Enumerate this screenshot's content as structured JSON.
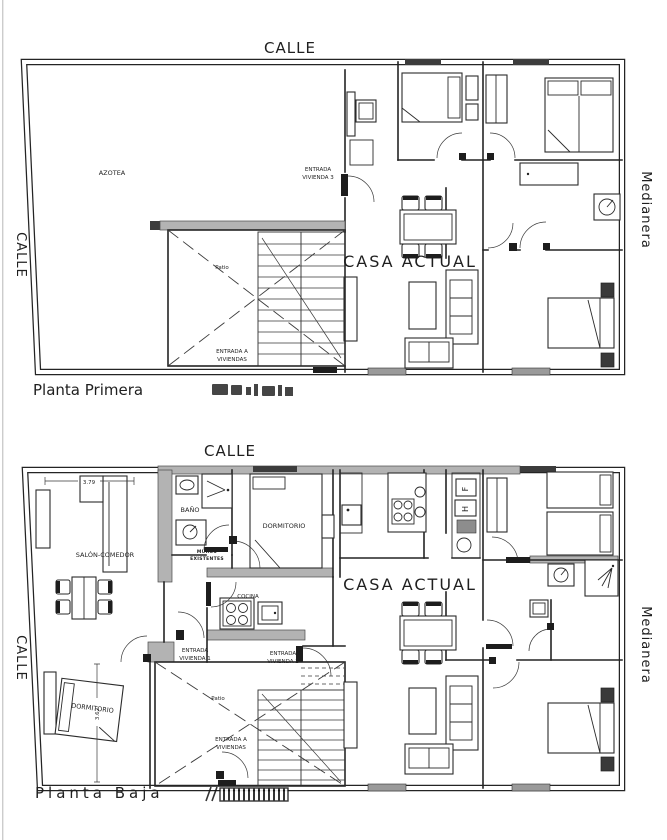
{
  "colors": {
    "ink": "#222222",
    "wall_gray": "#b3b3b3",
    "paper": "#ffffff"
  },
  "plan_primera": {
    "name": "Planta Primera",
    "labels": {
      "calle_top": "CALLE",
      "calle_left": "CALLE",
      "medianera": "Medianera",
      "azotea": "AZOTEA",
      "casa_actual": "CASA ACTUAL",
      "patio": "Patio",
      "entrada_vivienda_3_l1": "ENTRADA",
      "entrada_vivienda_3_l2": "VIVIENDA 3",
      "entrada_viviendas_l1": "ENTRADA A",
      "entrada_viviendas_l2": "VIVIENDAS"
    }
  },
  "plan_baja": {
    "name": "Planta Baja",
    "labels": {
      "calle_top": "CALLE",
      "calle_left": "CALLE",
      "medianera": "Medianera",
      "salon_comedor": "SALÓN-COMEDOR",
      "bano": "BAÑO",
      "dormitorio_top": "DORMITORIO",
      "cocina": "COCINA",
      "muros_l1": "MUROS",
      "muros_l2": "EXISTENTES",
      "entrada_vivienda_1_l1": "ENTRADA",
      "entrada_vivienda_1_l2": "VIVIENDA 1",
      "entrada_vivienda_2_l1": "ENTRADA",
      "entrada_vivienda_2_l2": "VIVIENDA 2",
      "patio": "Patio",
      "entrada_viviendas_l1": "ENTRADA A",
      "entrada_viviendas_l2": "VIVIENDAS",
      "casa_actual": "CASA ACTUAL",
      "dormitorio_bottom": "DORMITORIO",
      "fridge": "F",
      "oven": "H"
    },
    "dimensions": {
      "salon_width": "3.79",
      "dormitorio_height": "3.62"
    }
  }
}
